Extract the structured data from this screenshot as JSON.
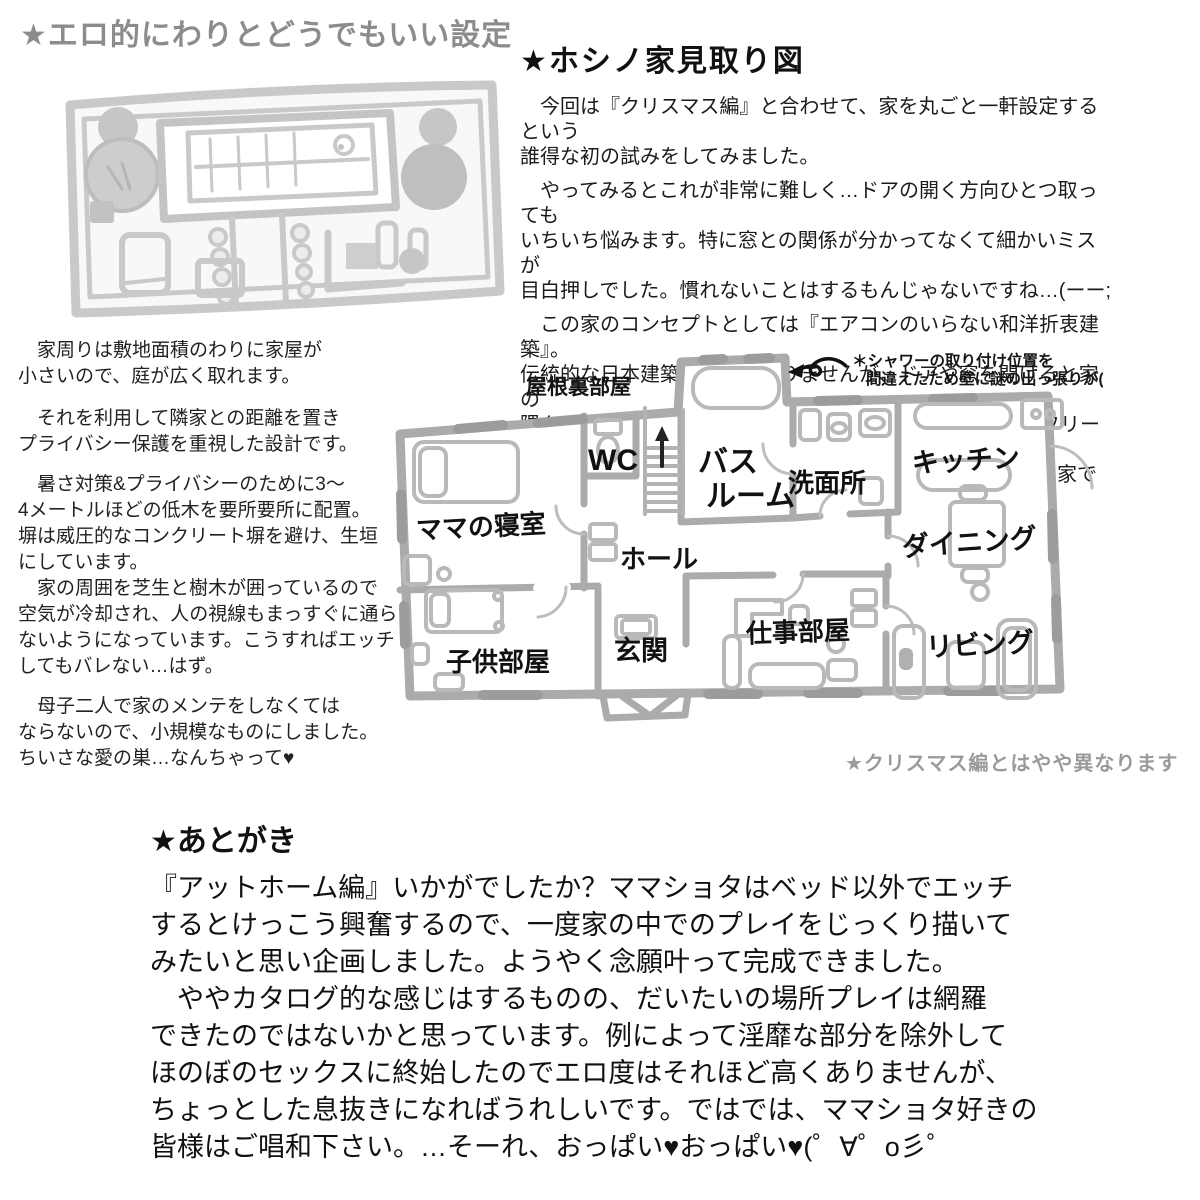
{
  "title_top_left": "★エロ的にわりとどうでもいい設定",
  "right_column": {
    "title": "★ホシノ家見取り図",
    "p1": "　今回は『クリスマス編』と合わせて、家を丸ごと一軒設定するという\n誰得な初の試みをしてみました。",
    "p2": "　やってみるとこれが非常に難しく…ドアの開く方向ひとつ取っても\nいちいち悩みます。特に窓との関係が分かってなくて細かいミスが\n目白押しでした。慣れないことはするもんじゃないですね…(ーー;",
    "p3": "　この家のコンセプトとしては『エアコンのいらない和洋折衷建築』。\n伝統的な日本建築ほどではありませんが、ドアや窓を開けると家の\n隅々に風が通るよう意識しました。また将来的にはバリアフリーが\n出来るようになっています。総じて開放的なこじんまりした家です。"
  },
  "left_column": {
    "p1": "　家周りは敷地面積のわりに家屋が\n小さいので、庭が広く取れます。",
    "p2": "　それを利用して隣家との距離を置き\nプライバシー保護を重視した設計です。",
    "p3": "　暑さ対策&プライバシーのために3〜\n4メートルほどの低木を要所要所に配置。\n塀は威圧的なコンクリート塀を避け、生垣\nにしています。",
    "p4": "　家の周囲を芝生と樹木が囲っているので\n空気が冷却され、人の視線もまっすぐに通ら\nないようになっています。こうすればエッチ\nしてもバレない…はず。",
    "p5": "　母子二人で家のメンテをしなくては\nならないので、小規模なものにしました。\nちいさな愛の巣…なんちゃって♥"
  },
  "floorplan": {
    "attic_label": "屋根裏部屋",
    "annotation_line1": "＊シャワーの取り付け位置を",
    "annotation_line2": "間違えたため壁に謎の出っ張りが(汗",
    "rooms": {
      "wc": "WC",
      "bathroom_line1": "バス",
      "bathroom_line2": "ルーム",
      "washroom": "洗面所",
      "kitchen": "キッチン",
      "mama_bedroom": "ママの寝室",
      "hall": "ホール",
      "dining": "ダイニング",
      "kids_room": "子供部屋",
      "entrance": "玄関",
      "work_room": "仕事部屋",
      "living": "リビング"
    },
    "note": "★クリスマス編とはやや異なります"
  },
  "afterword": {
    "title": "★あとがき",
    "body": "『アットホーム編』いかがでしたか？ママショタはベッド以外でエッチ\nするとけっこう興奮するので、一度家の中でのプレイをじっくり描いて\nみたいと思い企画しました。ようやく念願叶って完成できました。\n　ややカタログ的な感じはするものの、だいたいの場所プレイは網羅\nできたのではないかと思っています。例によって淫靡な部分を除外して\nほのぼのセックスに終始したのでエロ度はそれほど高くありませんが、\nちょっとした息抜きになればうれしいです。ではでは、ママショタ好きの\n皆様はご唱和下さい。…そーれ、おっぱい♥おっぱい♥(゜∀゜o彡゜"
  },
  "colors": {
    "handwritten_gray": "#8c8c8c",
    "plan_wall": "#ababab",
    "plan_furniture": "#b9b9b9",
    "sketch_gray": "#c9c9c9",
    "text_black": "#111111",
    "note_gray": "#9a9a9a"
  }
}
